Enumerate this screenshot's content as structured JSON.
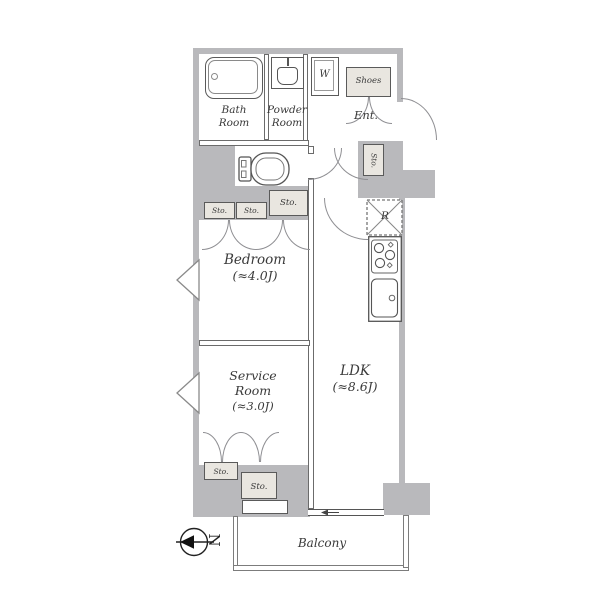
{
  "theme": {
    "wall_color": "#b9b9bc",
    "cabinet_fill": "#e9e6e0",
    "line_color": "#5a5a5a",
    "arc_color": "#8f8f93",
    "text_color": "#3a3a3a",
    "background": "#ffffff"
  },
  "rooms": {
    "bath": {
      "line1": "Bath",
      "line2": "Room"
    },
    "powder": {
      "line1": "Powder",
      "line2": "Room"
    },
    "entrance": {
      "label": "Ent."
    },
    "shoes": {
      "label": "Shoes"
    },
    "washer": {
      "label": "W"
    },
    "refrigerator": {
      "label": "R"
    },
    "bedroom": {
      "line1": "Bedroom",
      "line2": "(≈4.0J)"
    },
    "service": {
      "line1": "Service",
      "line2": "Room",
      "line3": "(≈3.0J)"
    },
    "ldk": {
      "line1": "LDK",
      "line2": "(≈8.6J)"
    },
    "balcony": {
      "label": "Balcony"
    },
    "storage_label": "Sto.",
    "compass_north": "N"
  }
}
